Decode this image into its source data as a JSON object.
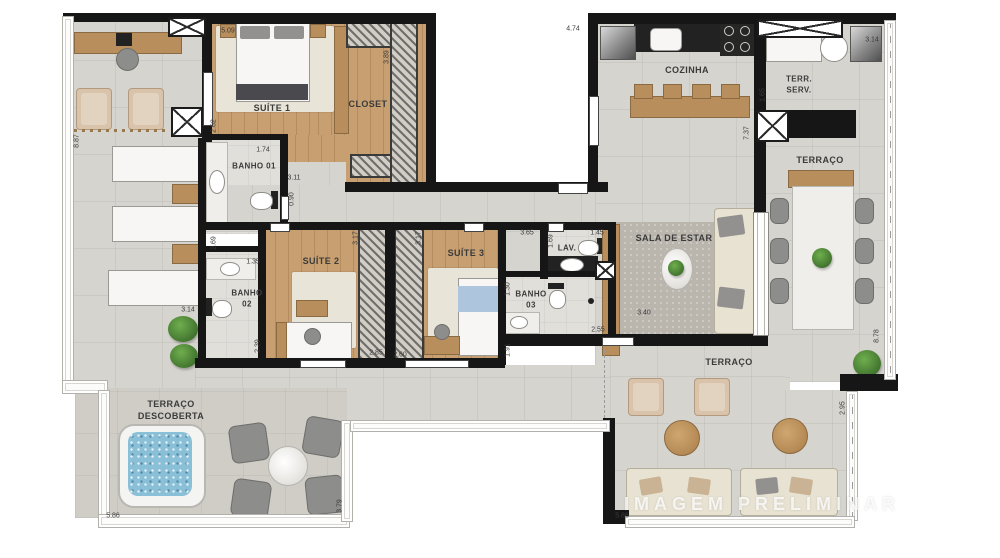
{
  "watermark": "IMAGEM PRELIMINAR",
  "rooms": {
    "suite1": "SUÍTE 1",
    "closet": "CLOSET",
    "banho1": "BANHO 01",
    "suite2": "SUÍTE 2",
    "banho2_l1": "BANHO",
    "banho2_l2": "02",
    "suite3": "SUÍTE 3",
    "banho3_l1": "BANHO",
    "banho3_l2": "03",
    "lav": "LAV.",
    "sala": "SALA DE ESTAR",
    "cozinha": "COZINHA",
    "terr_serv_l1": "TERR.",
    "terr_serv_l2": "SERV.",
    "terraco_right": "TERRAÇO",
    "terraco_bottom": "TERRAÇO",
    "terraco_desc_l1": "TERRAÇO",
    "terraco_desc_l2": "DESCOBERTA"
  },
  "dims": {
    "d5_09": "5.09",
    "d3_89": "3.89",
    "d4_74": "4.74",
    "d3_14_top": "3.14",
    "d1_65": "1.65",
    "d7_37": "7.37",
    "d8_87": "8.87",
    "d2_62": "2.62",
    "d1_74": "1.74",
    "d3_11": "3.11",
    "d0_90": "0.90",
    "d2_69": "2.69",
    "d1_35": "1.35",
    "d3_14_left": "3.14",
    "d2_39": "2.39",
    "d3_17_a": "3.17",
    "d3_17_b": "3.17",
    "d2_85": "2.85",
    "d2_60": "2.60",
    "d3_65": "3.65",
    "d1_69": "1.69",
    "d1_45": "1.45",
    "d1_30": "1.30",
    "d1_91": "1.91",
    "d2_55": "2.55",
    "d3_40": "3.40",
    "d8_78": "8.78",
    "d2_95": "2.95",
    "d3_79": "3.79",
    "d5_86_left": "5.86",
    "d5_86_right": "5.86"
  }
}
